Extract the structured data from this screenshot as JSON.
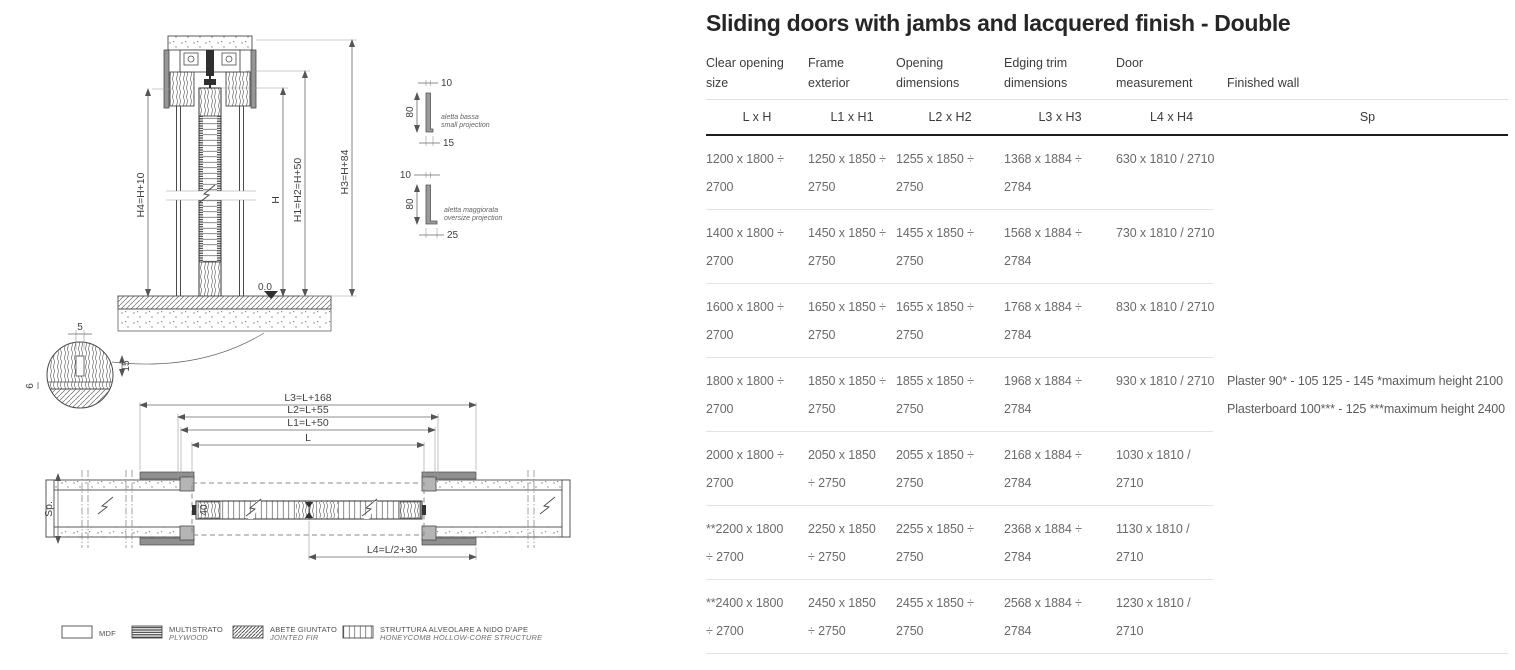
{
  "title": "Sliding doors with jambs and lacquered finish - Double",
  "colors": {
    "heading_text": "#262626",
    "body_text": "#6a6a6a",
    "rule_dark": "#1d1d1d",
    "rule_light": "#e3e3e3"
  },
  "table": {
    "headers": [
      "Clear opening\nsize",
      "Frame\nexterior",
      "Opening\ndimensions",
      "Edging trim\ndimensions",
      "Door\nmeasurement",
      "Finished wall"
    ],
    "subheaders": [
      "L x H",
      "L1 x H1",
      "L2 x H2",
      "L3 x H3",
      "L4 x H4",
      "Sp"
    ],
    "rows": [
      {
        "cells": [
          "1200 x 1800 ÷\n2700",
          "1250 x 1850 ÷\n2750",
          "1255 x 1850 ÷\n2750",
          "1368 x 1884 ÷\n2784",
          "630 x 1810 / 2710",
          ""
        ]
      },
      {
        "cells": [
          "1400 x 1800 ÷\n2700",
          "1450 x 1850 ÷\n2750",
          "1455 x 1850 ÷\n2750",
          "1568 x 1884 ÷\n2784",
          "730 x 1810 / 2710",
          ""
        ]
      },
      {
        "cells": [
          "1600 x 1800 ÷\n2700",
          "1650 x 1850 ÷\n2750",
          "1655 x 1850 ÷\n2750",
          "1768 x 1884 ÷\n2784",
          "830 x 1810 / 2710",
          ""
        ]
      },
      {
        "cells": [
          "1800 x 1800 ÷\n2700",
          "1850 x 1850 ÷\n2750",
          "1855 x 1850 ÷\n2750",
          "1968 x 1884 ÷\n2784",
          "930 x 1810 / 2710",
          "Plaster 90* - 105 125 - 145 *maximum height 2100\nPlasterboard 100*** - 125 ***maximum height 2400"
        ]
      },
      {
        "cells": [
          "2000 x 1800 ÷\n2700",
          "2050 x 1850\n÷ 2750",
          "2055 x 1850 ÷\n2750",
          "2168 x 1884 ÷\n2784",
          "1030 x 1810 /\n2710",
          ""
        ]
      },
      {
        "cells": [
          "**2200 x 1800\n÷ 2700",
          "2250 x 1850\n÷ 2750",
          "2255 x 1850 ÷\n2750",
          "2368 x 1884 ÷\n2784",
          "1130 x 1810 /\n2710",
          ""
        ]
      },
      {
        "cells": [
          "**2400 x 1800\n÷ 2700",
          "2450 x 1850\n÷ 2750",
          "2455 x 1850 ÷\n2750",
          "2568 x 1884 ÷\n2784",
          "1230 x 1810 /\n2710",
          ""
        ]
      }
    ]
  },
  "drawing": {
    "section": {
      "dim_h4": "H4=H+10",
      "dim_h": "H",
      "dim_h1": "H1=H2=H+50",
      "dim_h3": "H3=H+84",
      "datum": "0.0"
    },
    "profiles": {
      "small": {
        "top": "10",
        "height": "80",
        "bottom": "15",
        "label_it": "aletta bassa",
        "label_en": "small projection"
      },
      "oversize": {
        "top": "10",
        "height": "80",
        "bottom": "25",
        "label_it": "aletta maggiorata",
        "label_en": "oversize projection"
      }
    },
    "detail": {
      "top": "5",
      "right": "15",
      "left": "6"
    },
    "plan": {
      "dim_l3": "L3=L+168",
      "dim_l2": "L2=L+55",
      "dim_l1": "L1=L+50",
      "dim_l": "L",
      "dim_l4": "L4=L/2+30",
      "dim_sp": "Sp.",
      "panel_40": "40"
    }
  },
  "legend": {
    "items": [
      {
        "label1": "MDF",
        "label2": ""
      },
      {
        "label1": "MULTISTRATO",
        "label2": "PLYWOOD"
      },
      {
        "label1": "ABETE GIUNTATO",
        "label2": "JOINTED FIR"
      },
      {
        "label1": "STRUTTURA ALVEOLARE A NIDO D'APE",
        "label2": "HONEYCOMB HOLLOW-CORE STRUCTURE"
      }
    ]
  }
}
